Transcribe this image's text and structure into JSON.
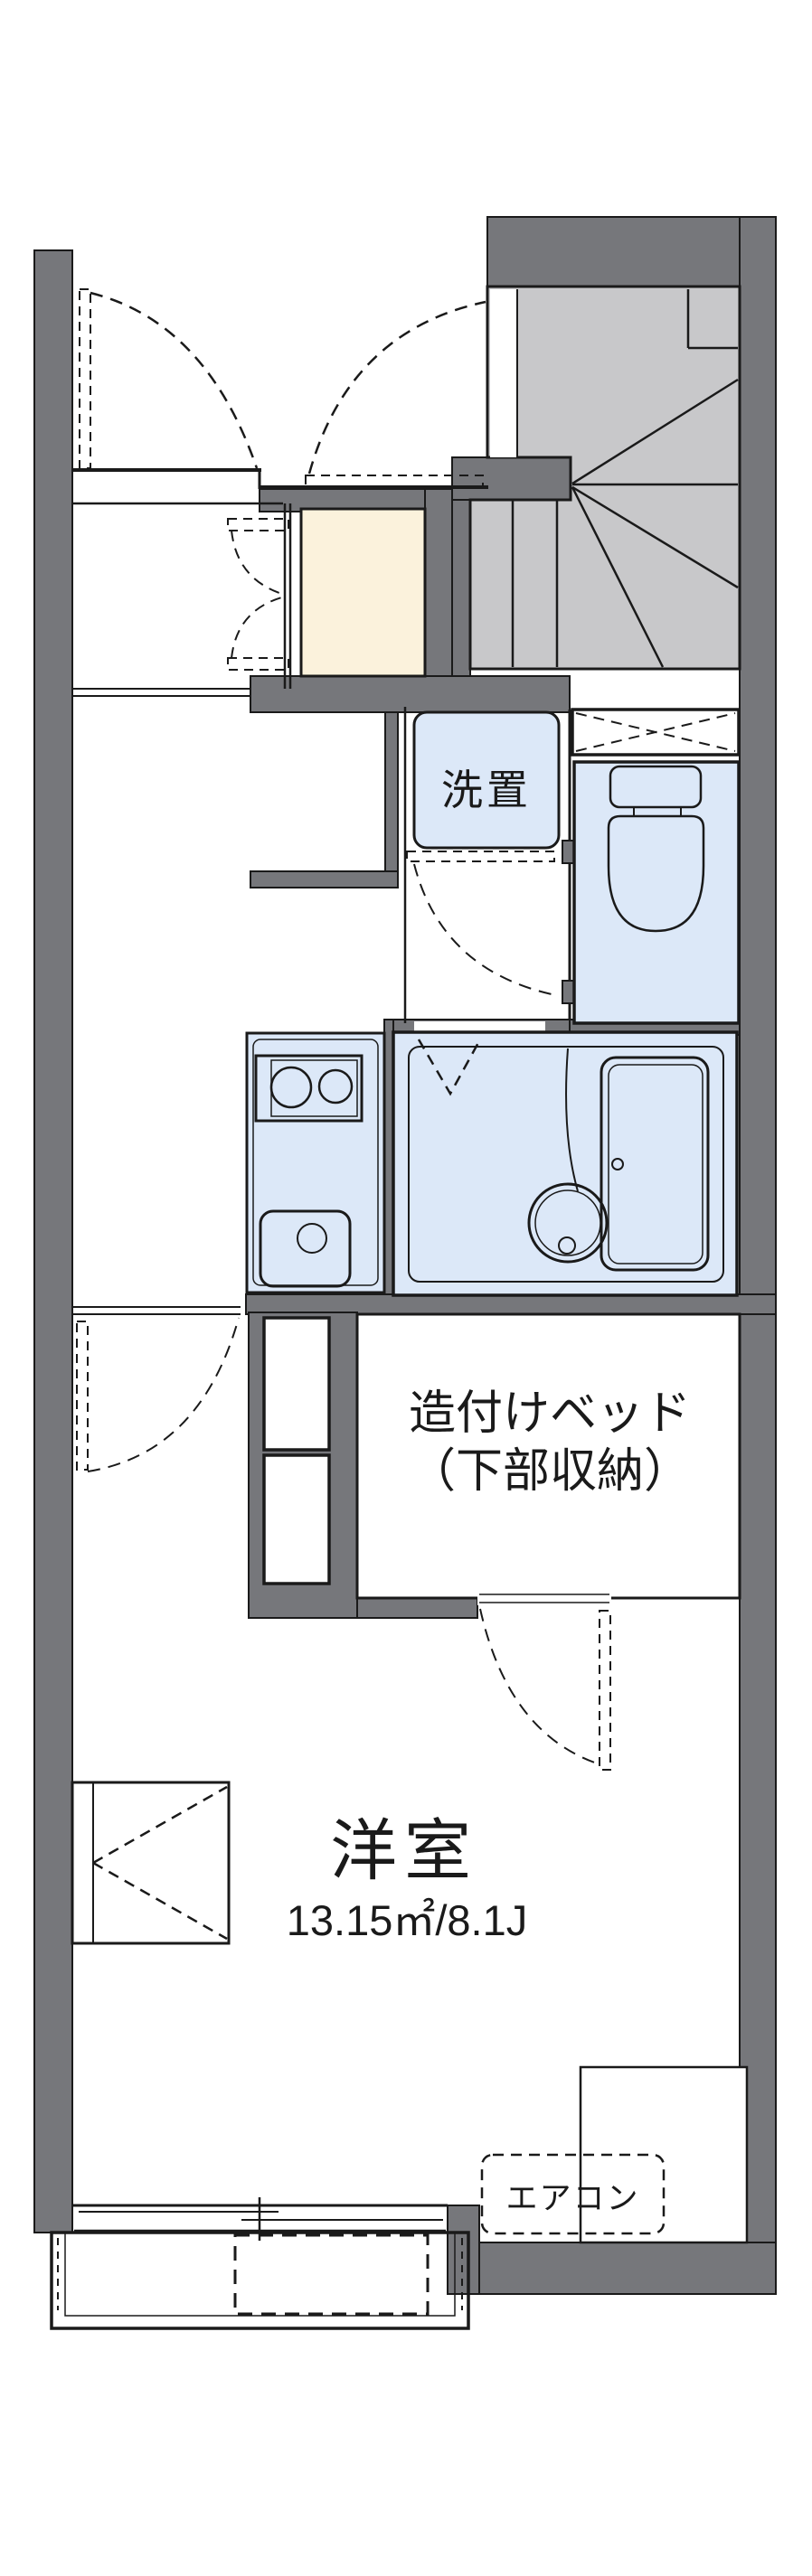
{
  "document": {
    "type": "floor-plan",
    "language": "ja"
  },
  "colors": {
    "wall_gray": "#76777B",
    "stair_gray": "#C8C8CA",
    "wet_area_blue": "#DCE8F8",
    "entry_beige": "#FBF2DC",
    "line_black": "#1A1A1A",
    "background": "#FFFFFF"
  },
  "labels": {
    "laundry": "洗置",
    "built_in_bed_line1": "造付けベッド",
    "built_in_bed_line2": "（下部収納）",
    "main_room_name": "洋室",
    "main_room_size": "13.15㎡/8.1J",
    "air_conditioner": "エアコン"
  }
}
